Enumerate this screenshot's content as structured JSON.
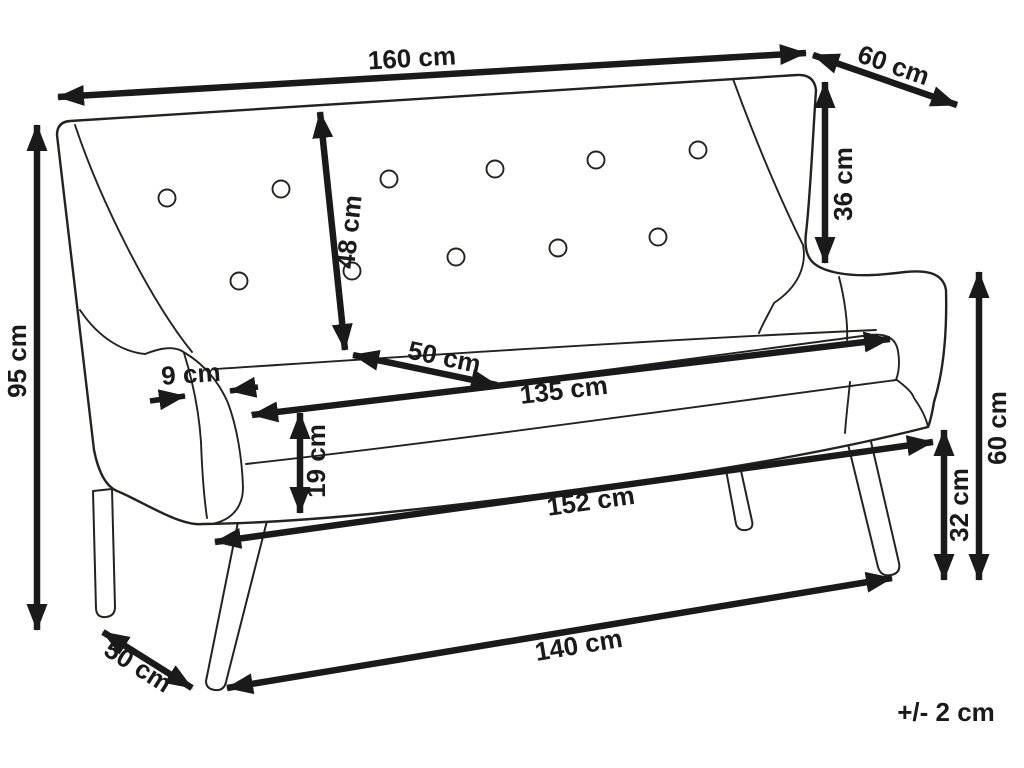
{
  "diagram": {
    "unit": "cm",
    "colors": {
      "line": "#1a1a1a",
      "outline": "#222220",
      "background": "#ffffff"
    },
    "tolerance": {
      "label": "+/- 2 cm"
    },
    "dimensions": [
      {
        "id": "overall-width",
        "value": 160,
        "unit": "cm",
        "label": "160 cm"
      },
      {
        "id": "overall-depth-top",
        "value": 60,
        "unit": "cm",
        "label": "60 cm"
      },
      {
        "id": "overall-height",
        "value": 95,
        "unit": "cm",
        "label": "95 cm"
      },
      {
        "id": "backrest-height",
        "value": 48,
        "unit": "cm",
        "label": "48 cm"
      },
      {
        "id": "seat-depth",
        "value": 50,
        "unit": "cm",
        "label": "50 cm"
      },
      {
        "id": "armrest-thickness",
        "value": 9,
        "unit": "cm",
        "label": "9 cm"
      },
      {
        "id": "seat-width",
        "value": 135,
        "unit": "cm",
        "label": "135 cm"
      },
      {
        "id": "cushion-thickness",
        "value": 19,
        "unit": "cm",
        "label": "19 cm"
      },
      {
        "id": "base-width",
        "value": 152,
        "unit": "cm",
        "label": "152 cm"
      },
      {
        "id": "wing-side-height",
        "value": 36,
        "unit": "cm",
        "label": "36 cm"
      },
      {
        "id": "arm-height",
        "value": 60,
        "unit": "cm",
        "label": "60 cm"
      },
      {
        "id": "leg-height",
        "value": 32,
        "unit": "cm",
        "label": "32 cm"
      },
      {
        "id": "leg-span-width",
        "value": 140,
        "unit": "cm",
        "label": "140 cm"
      },
      {
        "id": "leg-span-depth",
        "value": 50,
        "unit": "cm",
        "label": "50 cm"
      }
    ]
  }
}
